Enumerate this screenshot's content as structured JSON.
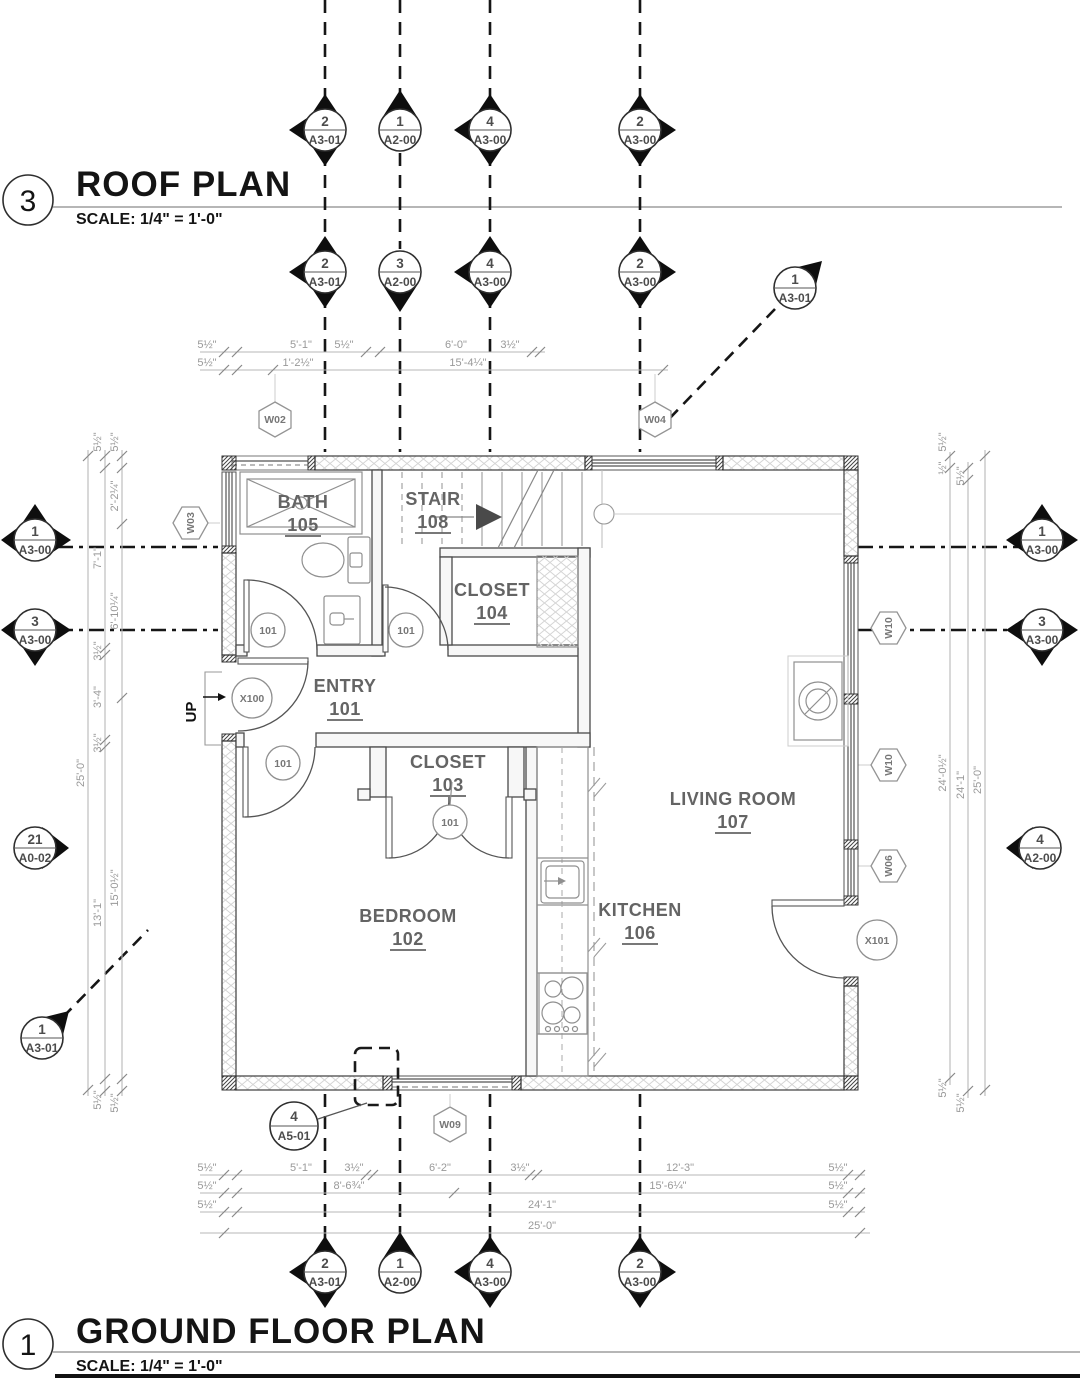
{
  "titles": {
    "roof": {
      "number": "3",
      "title": "ROOF PLAN",
      "scale": "SCALE: 1/4\"  =  1'-0\""
    },
    "ground": {
      "number": "1",
      "title": "GROUND FLOOR PLAN",
      "scale": "SCALE: 1/4\"  =  1'-0\""
    }
  },
  "rooms": {
    "bath": {
      "name": "BATH",
      "number": "105"
    },
    "stair": {
      "name": "STAIR",
      "number": "108"
    },
    "closet104": {
      "name": "CLOSET",
      "number": "104"
    },
    "entry": {
      "name": "ENTRY",
      "number": "101"
    },
    "closet103": {
      "name": "CLOSET",
      "number": "103"
    },
    "bedroom": {
      "name": "BEDROOM",
      "number": "102"
    },
    "kitchen": {
      "name": "KITCHEN",
      "number": "106"
    },
    "living": {
      "name": "LIVING ROOM",
      "number": "107"
    }
  },
  "markers": {
    "top1": [
      {
        "num": "2",
        "sheet": "A3-01"
      },
      {
        "num": "1",
        "sheet": "A2-00"
      },
      {
        "num": "4",
        "sheet": "A3-00"
      },
      {
        "num": "2",
        "sheet": "A3-00"
      }
    ],
    "top2": [
      {
        "num": "2",
        "sheet": "A3-01"
      },
      {
        "num": "3",
        "sheet": "A2-00"
      },
      {
        "num": "4",
        "sheet": "A3-00"
      },
      {
        "num": "2",
        "sheet": "A3-00"
      },
      {
        "num": "1",
        "sheet": "A3-01"
      }
    ],
    "left": [
      {
        "num": "1",
        "sheet": "A3-00"
      },
      {
        "num": "3",
        "sheet": "A3-00"
      },
      {
        "num": "21",
        "sheet": "A0-02"
      },
      {
        "num": "1",
        "sheet": "A3-01"
      }
    ],
    "right": [
      {
        "num": "1",
        "sheet": "A3-00"
      },
      {
        "num": "3",
        "sheet": "A3-00"
      },
      {
        "num": "4",
        "sheet": "A2-00"
      }
    ],
    "bottom": [
      {
        "num": "2",
        "sheet": "A3-01"
      },
      {
        "num": "1",
        "sheet": "A2-00"
      },
      {
        "num": "4",
        "sheet": "A3-00"
      },
      {
        "num": "2",
        "sheet": "A3-00"
      }
    ],
    "detail": {
      "num": "4",
      "sheet": "A5-01"
    }
  },
  "tags": {
    "w02": "W02",
    "w03": "W03",
    "w04": "W04",
    "w06": "W06",
    "w09": "W09",
    "w10": "W10",
    "x100": "X100",
    "x101": "X101",
    "door101": "101"
  },
  "labels": {
    "up": "UP"
  },
  "dims": {
    "top1": [
      "5½\"",
      "5'-1\"",
      "5½\"",
      "6'-0\"",
      "3½\""
    ],
    "top2": [
      "5½\"",
      "1'-2½\"",
      "15'-4¼\""
    ],
    "left_a": [
      "5½\"",
      "7'-1\"",
      "3½\"",
      "3'-4\"",
      "3½\"",
      "13'-1\"",
      "5½\""
    ],
    "left_b": [
      "5½\"",
      "2'-2¼\"",
      "6'-10¼\"",
      "15'-0½\"",
      "5½\""
    ],
    "left_total": "25'-0\"",
    "right_a": [
      "5½\"",
      "½\"",
      "24'-0½\"",
      "5½\""
    ],
    "right_b": [
      "5½\"",
      "24'-1\"",
      "5½\""
    ],
    "right_total": "25'-0\"",
    "bottom1": [
      "5½\"",
      "5'-1\"",
      "3½\"",
      "6'-2\"",
      "3½\"",
      "12'-3\"",
      "5½\""
    ],
    "bottom2": [
      "5½\"",
      "8'-6¾\"",
      "15'-6¼\"",
      "5½\""
    ],
    "bottom3": [
      "5½\"",
      "24'-1\"",
      "5½\""
    ],
    "bottom_total": "25'-0\""
  },
  "colors": {
    "line_dark": "#161616",
    "line_wall": "#4a4a4a",
    "text_room": "#646464",
    "text_dim": "#999999",
    "hatch": "#d5d5d5"
  }
}
